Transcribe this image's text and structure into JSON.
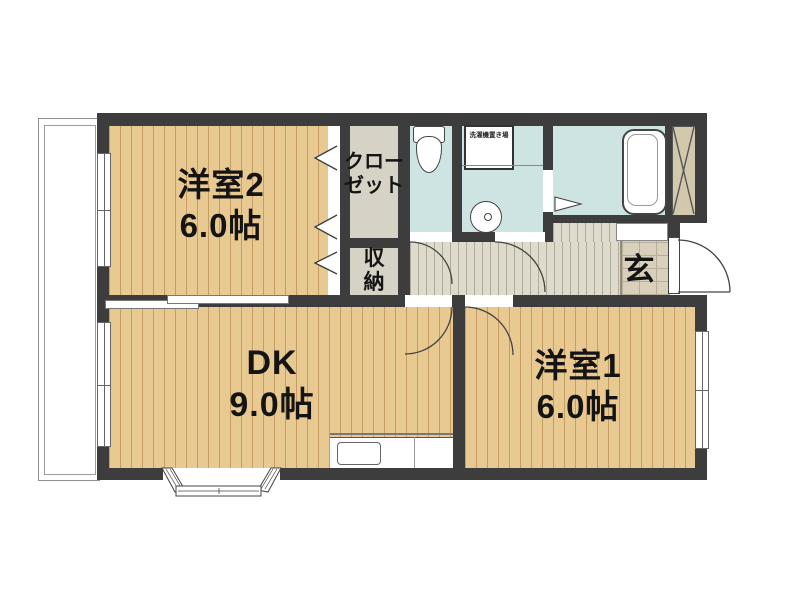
{
  "colors": {
    "wall": "#3d3d3d",
    "wood_floor": "#e9c992",
    "wet_area": "#cde4e2",
    "hallway": "#dedacc",
    "closet": "#d6d2c5",
    "genkan_tile": "#d8d0bb",
    "shaft": "#d2c9ad",
    "text": "#141414"
  },
  "rooms": {
    "west2": {
      "name": "洋室2",
      "area": "6.0帖"
    },
    "dk": {
      "name": "DK",
      "area": "9.0帖"
    },
    "west1": {
      "name": "洋室1",
      "area": "6.0帖"
    },
    "closet": {
      "line1": "クロー",
      "line2": "ゼット"
    },
    "storage": {
      "line1": "収",
      "line2": "納"
    },
    "entrance": {
      "label": "玄"
    },
    "laundry_space": {
      "label": "洗濯機置き場"
    }
  }
}
